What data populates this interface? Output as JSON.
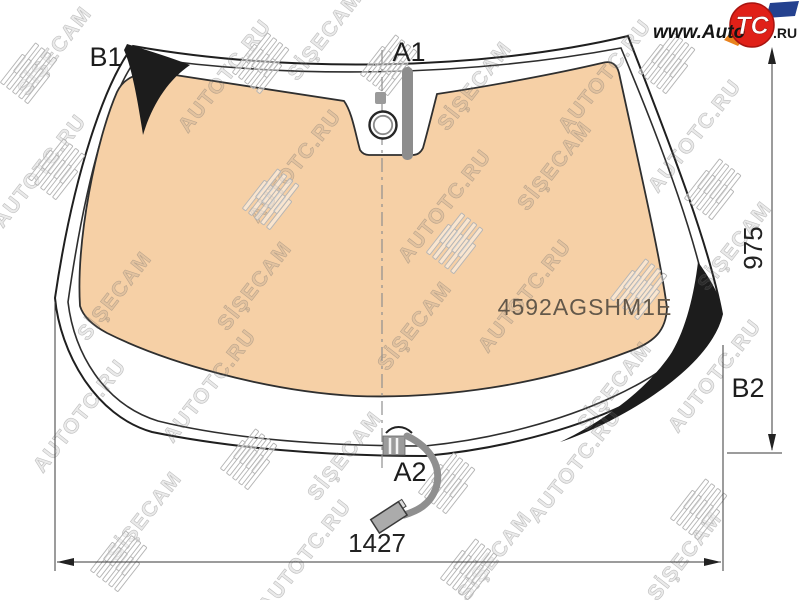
{
  "diagram": {
    "part_number": "4592AGSHM1E",
    "labels": {
      "b1": "B1",
      "a1": "A1",
      "a2": "A2",
      "b2": "B2"
    },
    "dimensions": {
      "width_mm": "1427",
      "height_mm": "975"
    },
    "colors": {
      "glass_tint": "#f6d0a6",
      "ceramic_black": "#1c1c1c",
      "logo_red": "#e02018",
      "logo_orange": "#e8821e",
      "logo_blue": "#24418f"
    }
  },
  "logo": {
    "www_auto": "www.Auto",
    "tc": "TC",
    "ru": ".RU"
  },
  "watermark": {
    "brand_glass": "SİŞECAM",
    "brand_site": "AUTOTC.RU"
  }
}
